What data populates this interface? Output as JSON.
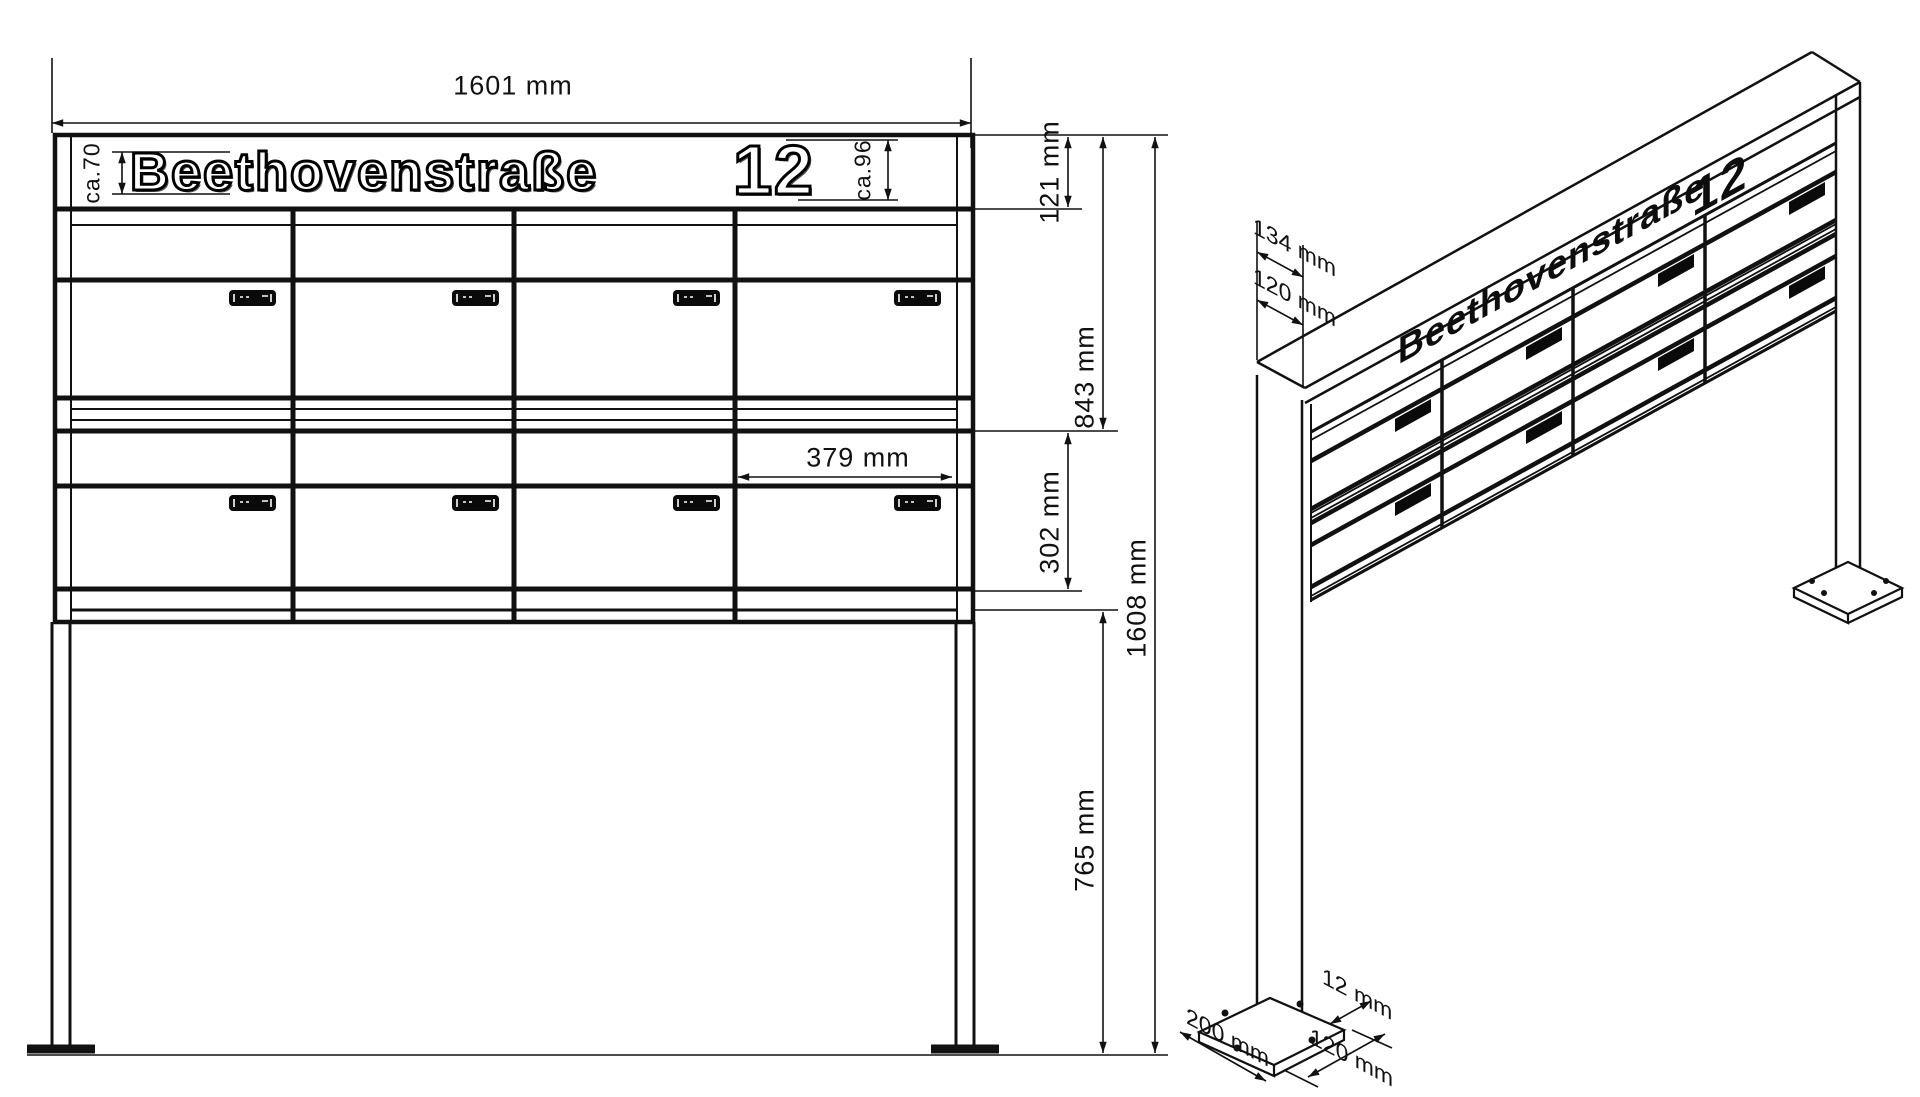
{
  "drawing": {
    "front": {
      "nameplate_text": "Beethovenstraße",
      "house_number": "12",
      "dim_total_width": "1601 mm",
      "dim_text_height": "ca.70",
      "dim_number_height": "ca.96",
      "dim_nameplate_row": "121 mm",
      "dim_box_height": "843 mm",
      "dim_row2_height": "302 mm",
      "dim_total_height": "1608 mm",
      "dim_leg_height": "765 mm",
      "dim_box_width": "379 mm"
    },
    "iso": {
      "nameplate_text": "Beethovenstraße",
      "house_number": "12",
      "dim_depth_top": "134 mm",
      "dim_depth_body": "120 mm",
      "dim_plate_length": "200 mm",
      "dim_plate_thickness": "12 mm",
      "dim_plate_width": "120 mm"
    }
  }
}
